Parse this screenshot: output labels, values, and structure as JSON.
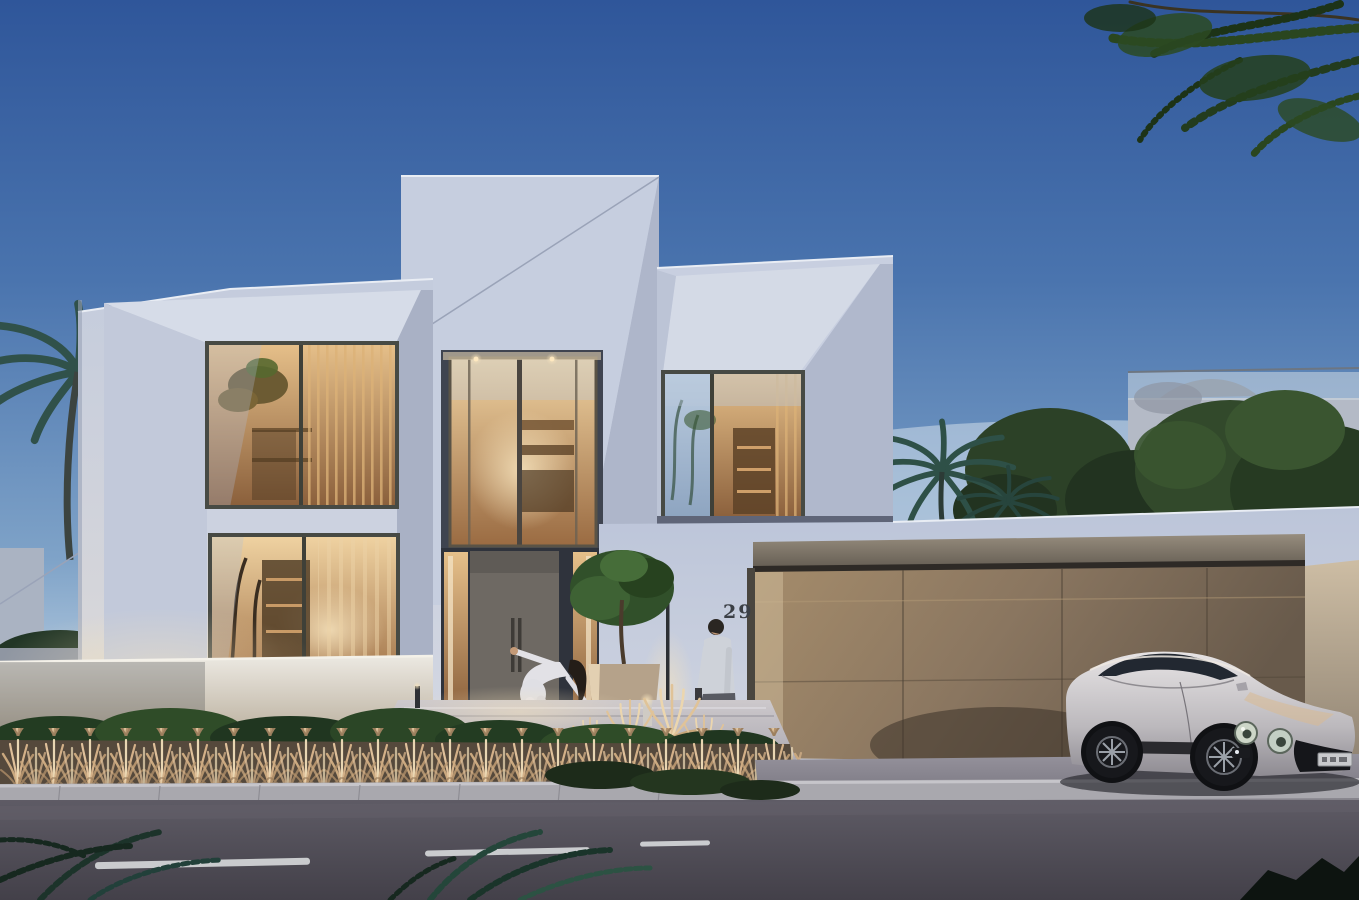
{
  "scene": {
    "type": "photorealistic architectural rendering",
    "time_of_day": "dusk",
    "description": "Modern two-storey white cubic villa at dusk with warm-lit interiors, wide bronze garage door, silver luxury coupe parked on the driveway, man walking and woman in white bending playfully on the entry walkway, palms and lush trees around, asphalt street with dashed lane line in the foreground",
    "house_number": "29",
    "license_plate": "illegible"
  },
  "palette": {
    "sky_top": "#2f569a",
    "sky_mid": "#5d85b8",
    "sky_horizon": "#dce6ee",
    "facade_light": "#ccd3e2",
    "facade_mid": "#b4bcd0",
    "facade_shadow": "#98a1b8",
    "window_warm": "#d8a86e",
    "window_warm_deep": "#8a5f3b",
    "glass_blue": "#a9bdd2",
    "door_taupe": "#6e6963",
    "garage_bronze_light": "#a18a6c",
    "garage_bronze_dark": "#6a5c4c",
    "road": "#534f59",
    "curb": "#a9a8ae",
    "walkway": "#b9bcc6",
    "boundary_wall": "#e3e0da",
    "foliage_dark": "#22351f",
    "foliage_mid": "#3c5a2e",
    "palm_teal": "#2c4a41",
    "dry_grass": "#d3b48c",
    "car_silver": "#c7c4c6",
    "warm_light": "#f0ddba",
    "house_number_color": "#3b3f45",
    "lane_marking": "#d8dadc"
  },
  "objects": {
    "house": {
      "storeys": 2,
      "style": "modern cubic volumes with chamfered window reveals",
      "lit_windows": 4,
      "front_door": "taupe pivot door with twin vertical pull handles and warm sidelights",
      "garage_door": "wide bronze panel door with vertical seams",
      "lighting": [
        "recessed soffit downlights",
        "vertical wall sconce",
        "threshold strip light",
        "bollard path lights"
      ]
    },
    "car": {
      "type": "luxury coupe",
      "color_name": "silver",
      "position": "parked on driveway in front of garage",
      "details": [
        "twin round headlights",
        "dark grille",
        "front license plate"
      ]
    },
    "people": [
      {
        "id": "man",
        "clothing": "light shirt and gray trousers",
        "action": "walking left along the front path"
      },
      {
        "id": "woman",
        "clothing": "white outfit, long dark hair",
        "action": "bending forward playfully on the walkway"
      }
    ],
    "vegetation": [
      "palm trees left",
      "palm behind garage wall",
      "overhanging branches top right",
      "potted tree by entrance",
      "ornamental dry grasses",
      "green hedges",
      "neighbor trees right"
    ],
    "street": {
      "surface": "asphalt",
      "lane_marking": "white dashed center line",
      "curb": "light concrete with joints"
    },
    "neighbor_house": {
      "position": "right background",
      "feature": "glass balustrade roof terrace"
    }
  }
}
